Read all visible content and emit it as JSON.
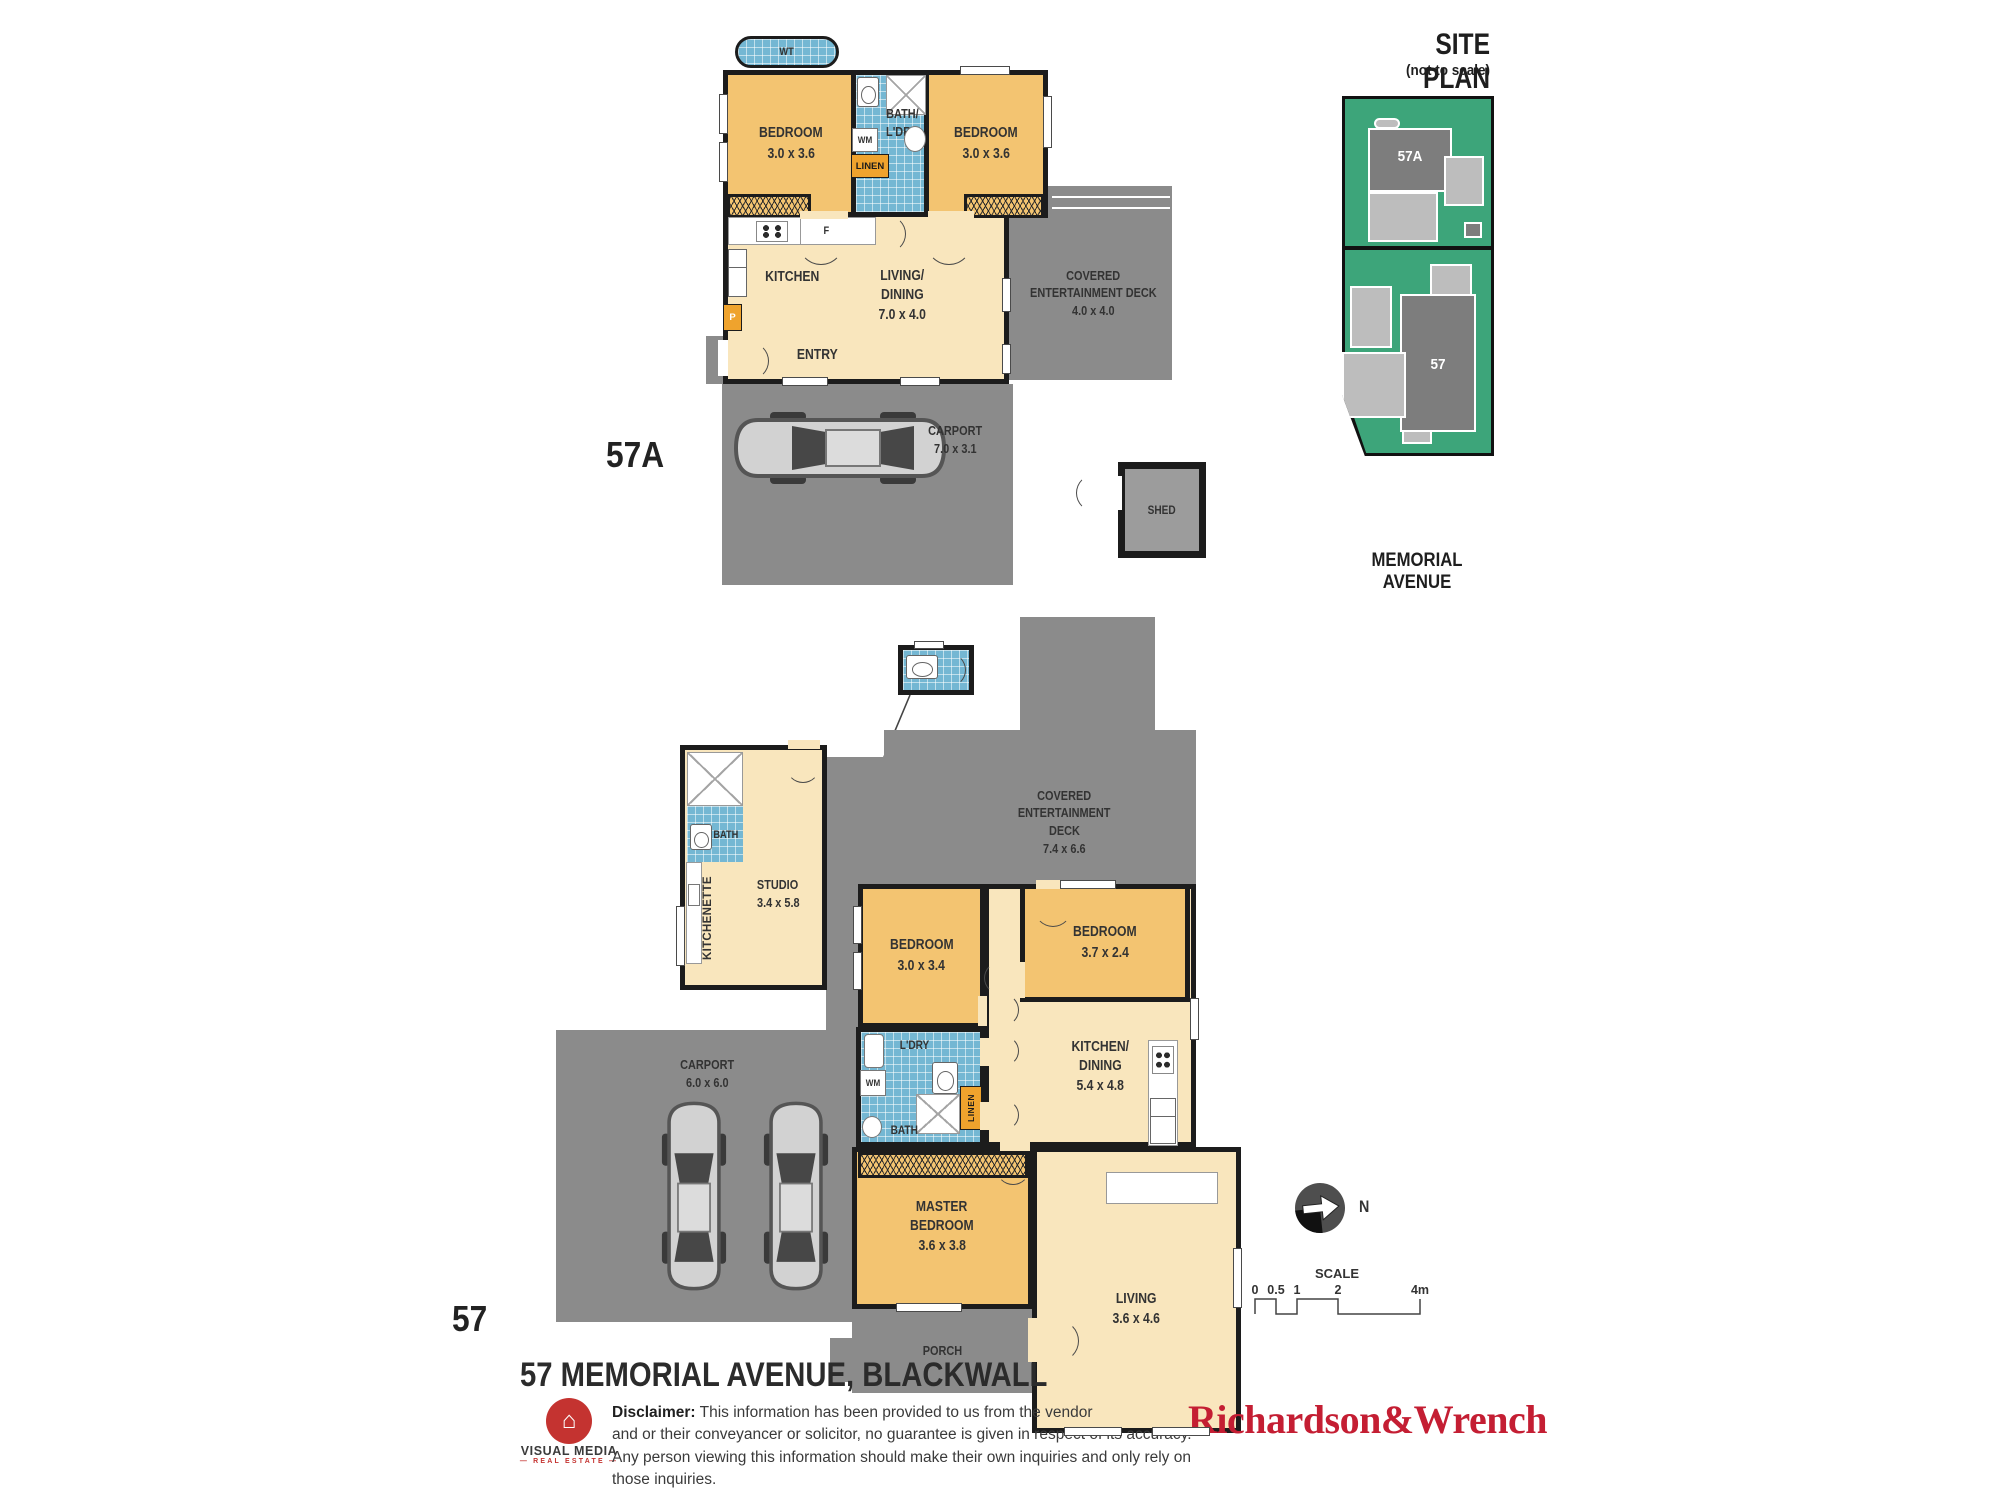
{
  "site_plan": {
    "title": "SITE PLAN",
    "subtitle": "(not to scale)",
    "street": "MEMORIAL AVENUE",
    "lot_a": "57A",
    "lot_b": "57"
  },
  "plan_a": {
    "unit": "57A",
    "wt": "WT",
    "bedroom_left": {
      "name": "BEDROOM",
      "dims": "3.0 x 3.6"
    },
    "bedroom_right": {
      "name": "BEDROOM",
      "dims": "3.0 x 3.6"
    },
    "bath": {
      "line1": "BATH/",
      "line2": "L'DRY"
    },
    "wm": "WM",
    "linen": "LINEN",
    "fridge": "F",
    "pantry": "P",
    "kitchen": "KITCHEN",
    "living": {
      "line1": "LIVING/",
      "line2": "DINING",
      "dims": "7.0 x 4.0"
    },
    "entry": "ENTRY",
    "deck": {
      "line1": "COVERED",
      "line2": "ENTERTAINMENT DECK",
      "dims": "4.0 x 4.0"
    },
    "carport": {
      "name": "CARPORT",
      "dims": "7.0 x 3.1"
    },
    "shed": "SHED"
  },
  "plan_b": {
    "unit": "57",
    "studio": {
      "name": "STUDIO",
      "dims": "3.4 x 5.8"
    },
    "studio_bath": "BATH",
    "kitchenette": "KITCHENETTE",
    "deck": {
      "line1": "COVERED",
      "line2": "ENTERTAINMENT",
      "line3": "DECK",
      "dims": "7.4 x 6.6"
    },
    "bedroom1": {
      "name": "BEDROOM",
      "dims": "3.0 x 3.4"
    },
    "bedroom2": {
      "name": "BEDROOM",
      "dims": "3.7 x 2.4"
    },
    "ldry": "L'DRY",
    "wm": "WM",
    "linen": "LINEN",
    "bath": "BATH",
    "kitchen": {
      "line1": "KITCHEN/",
      "line2": "DINING",
      "dims": "5.4 x 4.8"
    },
    "master": {
      "line1": "MASTER",
      "line2": "BEDROOM",
      "dims": "3.6 x 3.8"
    },
    "living": {
      "name": "LIVING",
      "dims": "3.6 x 4.6"
    },
    "porch": "PORCH",
    "carport": {
      "name": "CARPORT",
      "dims": "6.0 x 6.0"
    }
  },
  "compass": {
    "north": "N"
  },
  "scale_bar": {
    "title": "SCALE",
    "ticks": [
      "0",
      "0.5",
      "1",
      "2",
      "4m"
    ]
  },
  "footer": {
    "address": "57 MEMORIAL AVENUE, BLACKWALL",
    "disclaimer_label": "Disclaimer:",
    "disclaimer_lines": [
      "This information has been provided to us from the vendor",
      "and or their conveyancer or solicitor, no guarantee is given in respect of its accuracy.",
      "Any person viewing this information should make their own inquiries and only rely on those inquiries."
    ],
    "logo": {
      "name": "VISUAL MEDIA",
      "tagline": "REAL ESTATE"
    },
    "agency": "Richardson&Wrench"
  },
  "colors": {
    "bedroom_orange": "#f3c471",
    "living_cream": "#f9e6bd",
    "deck_gray": "#8b8b8b",
    "tile_blue": "#74b7d3",
    "wall_black": "#1c1c1c",
    "cabinet_amber": "#efa32d",
    "site_green": "#3da57a",
    "brand_red": "#c41e33"
  }
}
